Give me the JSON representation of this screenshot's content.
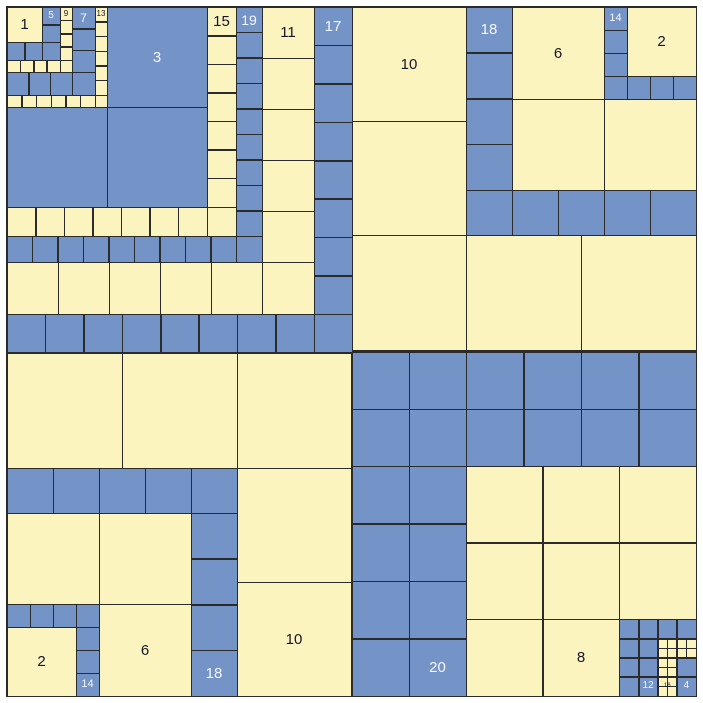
{
  "colors": {
    "yellow": "#fcf4bf",
    "blue": "#7493c6",
    "line": "#2b2b2b",
    "background": "#ffffff",
    "label_dark": "#15152a",
    "label_light": "#f5f7ff"
  },
  "board": {
    "width": 703,
    "height": 703,
    "frame": {
      "x": 6,
      "y": 6,
      "size": 691
    }
  },
  "strips": [
    {
      "n": "1",
      "q": "top-left",
      "c": "y",
      "runs": [
        [
          7,
          7,
          35,
          35,
          1,
          1
        ]
      ]
    },
    {
      "n": "5",
      "q": "top-left",
      "c": "b",
      "runs": [
        [
          42,
          7,
          18,
          17.5,
          1,
          2
        ],
        [
          42,
          42,
          18,
          18,
          1,
          1
        ],
        [
          7,
          42,
          17.5,
          18,
          2,
          1
        ]
      ]
    },
    {
      "n": "9",
      "q": "top-left",
      "c": "y",
      "runs": [
        [
          60,
          7,
          12,
          13.25,
          1,
          4
        ],
        [
          60,
          60,
          12,
          12,
          1,
          1
        ],
        [
          7,
          60,
          13.25,
          12,
          4,
          1
        ]
      ]
    },
    {
      "n": "7",
      "q": "top-left",
      "c": "b",
      "runs": [
        [
          72,
          7,
          23,
          21.67,
          1,
          3
        ],
        [
          72,
          72,
          23,
          23,
          1,
          1
        ],
        [
          7,
          72,
          21.67,
          23,
          3,
          1
        ]
      ]
    },
    {
      "n": "13",
      "q": "top-left",
      "c": "y",
      "runs": [
        [
          95,
          7,
          12,
          14.67,
          1,
          6
        ],
        [
          95,
          95,
          12,
          12,
          1,
          1
        ],
        [
          7,
          95,
          14.67,
          12,
          6,
          1
        ]
      ]
    },
    {
      "n": "3",
      "q": "top-left",
      "c": "b",
      "runs": [
        [
          107,
          7,
          100,
          100,
          1,
          1
        ],
        [
          107,
          107,
          100,
          100,
          1,
          1
        ],
        [
          7,
          107,
          100,
          100,
          1,
          1
        ]
      ]
    },
    {
      "n": "15",
      "q": "top-left",
      "c": "y",
      "runs": [
        [
          207,
          7,
          29,
          28.57,
          1,
          7
        ],
        [
          207,
          207,
          29,
          29,
          1,
          1
        ],
        [
          7,
          207,
          28.57,
          29,
          7,
          1
        ]
      ]
    },
    {
      "n": "19",
      "q": "top-left",
      "c": "b",
      "runs": [
        [
          236,
          7,
          26,
          25.44,
          1,
          9
        ],
        [
          236,
          236,
          26,
          26,
          1,
          1
        ],
        [
          7,
          236,
          25.44,
          26,
          9,
          1
        ]
      ]
    },
    {
      "n": "11",
      "q": "top-left",
      "c": "y",
      "runs": [
        [
          262,
          7,
          52,
          51,
          1,
          5
        ],
        [
          262,
          262,
          52,
          52,
          1,
          1
        ],
        [
          7,
          262,
          51,
          52,
          5,
          1
        ]
      ]
    },
    {
      "n": "17",
      "q": "top-left",
      "c": "b",
      "runs": [
        [
          314,
          7,
          38,
          38.38,
          1,
          8
        ],
        [
          314,
          314,
          38,
          38,
          1,
          1
        ],
        [
          7,
          314,
          38.38,
          38,
          8,
          1
        ]
      ]
    },
    {
      "n": "2",
      "q": "top-right",
      "c": "y",
      "runs": [
        [
          627,
          7,
          69,
          69,
          1,
          1
        ]
      ]
    },
    {
      "n": "14",
      "q": "top-right",
      "c": "b",
      "runs": [
        [
          604,
          7,
          23,
          23,
          1,
          3
        ],
        [
          604,
          76,
          23,
          23,
          1,
          1
        ],
        [
          627,
          76,
          23,
          23,
          3,
          1
        ]
      ]
    },
    {
      "n": "6",
      "q": "top-right",
      "c": "y",
      "runs": [
        [
          512,
          7,
          92,
          92,
          1,
          1
        ],
        [
          512,
          99,
          92,
          91,
          1,
          1
        ],
        [
          604,
          99,
          92,
          91,
          1,
          1
        ]
      ]
    },
    {
      "n": "18",
      "q": "top-right",
      "c": "b",
      "runs": [
        [
          466,
          7,
          46,
          45.75,
          1,
          4
        ],
        [
          466,
          190,
          46,
          45,
          1,
          1
        ],
        [
          512,
          190,
          46,
          45,
          4,
          1
        ]
      ]
    },
    {
      "n": "10",
      "q": "top-right",
      "c": "y",
      "runs": [
        [
          352,
          7,
          114,
          114,
          1,
          2
        ],
        [
          352,
          235,
          114,
          115,
          1,
          1
        ],
        [
          466,
          235,
          115,
          115,
          2,
          1
        ]
      ]
    },
    {
      "n": "2",
      "q": "bottom-left",
      "c": "y",
      "runs": [
        [
          7,
          627,
          69,
          69,
          1,
          1
        ]
      ]
    },
    {
      "n": "14",
      "q": "bottom-left",
      "c": "b",
      "runs": [
        [
          76,
          627,
          23,
          23,
          1,
          3
        ],
        [
          76,
          604,
          23,
          23,
          1,
          1
        ],
        [
          7,
          604,
          23,
          23,
          3,
          1
        ]
      ]
    },
    {
      "n": "6",
      "q": "bottom-left",
      "c": "y",
      "runs": [
        [
          99,
          604,
          92,
          92,
          1,
          1
        ],
        [
          99,
          513,
          92,
          91,
          1,
          1
        ],
        [
          7,
          513,
          92,
          91,
          1,
          1
        ]
      ]
    },
    {
      "n": "18",
      "q": "bottom-left",
      "c": "b",
      "runs": [
        [
          191,
          513,
          46,
          45.75,
          1,
          4
        ],
        [
          191,
          468,
          46,
          45,
          1,
          1
        ],
        [
          7,
          468,
          46,
          45,
          4,
          1
        ]
      ]
    },
    {
      "n": "10",
      "q": "bottom-left",
      "c": "y",
      "runs": [
        [
          237,
          468,
          114,
          114,
          1,
          2
        ],
        [
          237,
          353,
          114,
          115,
          1,
          1
        ],
        [
          7,
          353,
          115,
          115,
          2,
          1
        ]
      ]
    },
    {
      "n": "20",
      "q": "bottom-right",
      "c": "b",
      "runs": [
        [
          352,
          352,
          57,
          57,
          2,
          2
        ],
        [
          352,
          466,
          57,
          57.5,
          2,
          4
        ],
        [
          466,
          352,
          57.5,
          57,
          4,
          2
        ]
      ]
    },
    {
      "n": "8",
      "q": "bottom-right",
      "c": "y",
      "runs": [
        [
          466,
          466,
          76.67,
          76.67,
          3,
          2
        ],
        [
          466,
          619.34,
          76.67,
          76.66,
          2,
          1
        ]
      ]
    },
    {
      "n": "12",
      "q": "bottom-right",
      "c": "b",
      "runs": [
        [
          619.34,
          619.34,
          19.17,
          19.17,
          2,
          4
        ],
        [
          657.68,
          619.34,
          19.17,
          19.17,
          2,
          1
        ]
      ]
    },
    {
      "n": "16",
      "q": "bottom-right",
      "c": "y",
      "runs": [
        [
          657.68,
          638.51,
          9.58,
          9.58,
          4,
          2
        ],
        [
          657.68,
          657.68,
          9.58,
          9.58,
          2,
          4
        ]
      ]
    },
    {
      "n": "4",
      "q": "bottom-right",
      "c": "b",
      "runs": [
        [
          676.85,
          657.68,
          19.15,
          19.16,
          1,
          2
        ]
      ]
    }
  ],
  "labels": [
    {
      "t": "1",
      "x": 7,
      "y": 7,
      "w": 35,
      "h": 35,
      "c": "d"
    },
    {
      "t": "5",
      "x": 42,
      "y": 7,
      "w": 18,
      "h": 17.5,
      "c": "w"
    },
    {
      "t": "9",
      "x": 60,
      "y": 7,
      "w": 12,
      "h": 13.25,
      "c": "d"
    },
    {
      "t": "7",
      "x": 72,
      "y": 7,
      "w": 23,
      "h": 21.67,
      "c": "w"
    },
    {
      "t": "13",
      "x": 95,
      "y": 7,
      "w": 12,
      "h": 14.67,
      "c": "d"
    },
    {
      "t": "3",
      "x": 107,
      "y": 7,
      "w": 100,
      "h": 100,
      "c": "w"
    },
    {
      "t": "15",
      "x": 207,
      "y": 7,
      "w": 29,
      "h": 28.57,
      "c": "d"
    },
    {
      "t": "19",
      "x": 236,
      "y": 7,
      "w": 26,
      "h": 25.44,
      "c": "w"
    },
    {
      "t": "11",
      "x": 262,
      "y": 7,
      "w": 52,
      "h": 51,
      "c": "d"
    },
    {
      "t": "17",
      "x": 314,
      "y": 7,
      "w": 38,
      "h": 38.38,
      "c": "w"
    },
    {
      "t": "10",
      "x": 352,
      "y": 7,
      "w": 114,
      "h": 114,
      "c": "d"
    },
    {
      "t": "18",
      "x": 466,
      "y": 7,
      "w": 46,
      "h": 45.75,
      "c": "w"
    },
    {
      "t": "6",
      "x": 512,
      "y": 7,
      "w": 92,
      "h": 92,
      "c": "d"
    },
    {
      "t": "14",
      "x": 604,
      "y": 7,
      "w": 23,
      "h": 23,
      "c": "w",
      "fs": 11
    },
    {
      "t": "2",
      "x": 627,
      "y": 7,
      "w": 69,
      "h": 69,
      "c": "d"
    },
    {
      "t": "2",
      "x": 7,
      "y": 627,
      "w": 69,
      "h": 69,
      "c": "d"
    },
    {
      "t": "14",
      "x": 76,
      "y": 673,
      "w": 23,
      "h": 23,
      "c": "w",
      "fs": 11
    },
    {
      "t": "6",
      "x": 99,
      "y": 604,
      "w": 92,
      "h": 92,
      "c": "d"
    },
    {
      "t": "18",
      "x": 191,
      "y": 650.25,
      "w": 46,
      "h": 45.75,
      "c": "w"
    },
    {
      "t": "10",
      "x": 237,
      "y": 582,
      "w": 114,
      "h": 114,
      "c": "d"
    },
    {
      "t": "20",
      "x": 409,
      "y": 638.5,
      "w": 57,
      "h": 57.5,
      "c": "w"
    },
    {
      "t": "8",
      "x": 542.67,
      "y": 619.34,
      "w": 76.67,
      "h": 76.66,
      "c": "d"
    },
    {
      "t": "12",
      "x": 638.51,
      "y": 676.85,
      "w": 19.17,
      "h": 19.17,
      "c": "w",
      "fs": 10
    },
    {
      "t": "16",
      "x": 657.68,
      "y": 676.85,
      "w": 19.16,
      "h": 19.16,
      "c": "d",
      "fs": 6
    },
    {
      "t": "4",
      "x": 676.85,
      "y": 676.84,
      "w": 19.15,
      "h": 19.16,
      "c": "w",
      "fs": 10
    }
  ]
}
